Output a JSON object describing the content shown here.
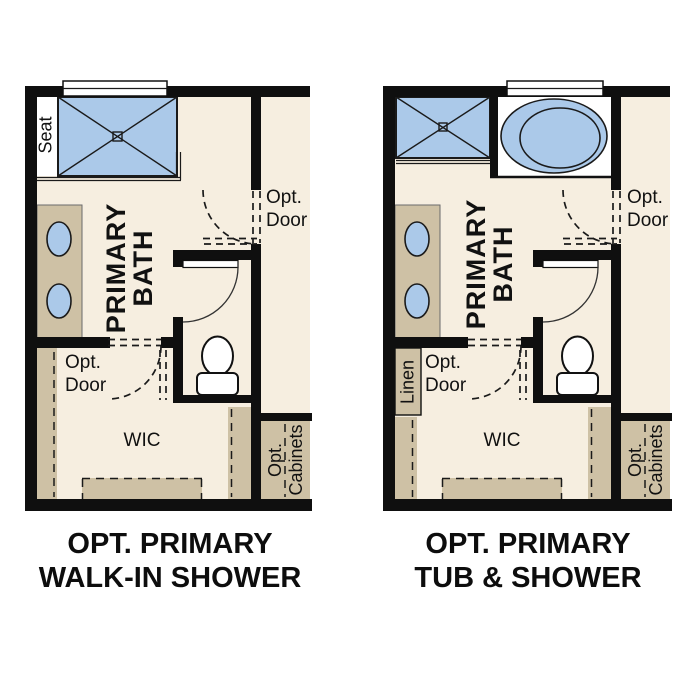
{
  "colors": {
    "cream": "#f6eee0",
    "tan": "#cec1a5",
    "blue": "#abc9e9",
    "wall": "#0f0f0f",
    "text": "#111111"
  },
  "plans": [
    {
      "id": "walk-in-shower-option",
      "caption": {
        "line1": "OPT. PRIMARY",
        "line2": "WALK-IN SHOWER"
      },
      "labels": {
        "seat": "Seat",
        "primary_bath": "PRIMARY\nBATH",
        "opt_door_hall": "Opt.\nDoor",
        "opt_door_wic": "Opt.\nDoor",
        "wic": "WIC",
        "opt_cabinets": "Opt.\nCabinets"
      },
      "fixtures": [
        "walk-in-shower-with-seat",
        "window",
        "vanity-two-sinks",
        "toilet",
        "door-swing",
        "optional-doors",
        "closet-shelving",
        "optional-cabinets"
      ]
    },
    {
      "id": "tub-and-shower-option",
      "caption": {
        "line1": "OPT. PRIMARY",
        "line2": "TUB & SHOWER"
      },
      "labels": {
        "linen": "Linen",
        "primary_bath": "PRIMARY\nBATH",
        "opt_door_hall": "Opt.\nDoor",
        "opt_door_wic": "Opt.\nDoor",
        "wic": "WIC",
        "opt_cabinets": "Opt.\nCabinets"
      },
      "fixtures": [
        "shower",
        "oval-tub",
        "window",
        "vanity-two-sinks",
        "toilet",
        "door-swing",
        "optional-doors",
        "linen-closet",
        "closet-shelving",
        "optional-cabinets"
      ]
    }
  ]
}
